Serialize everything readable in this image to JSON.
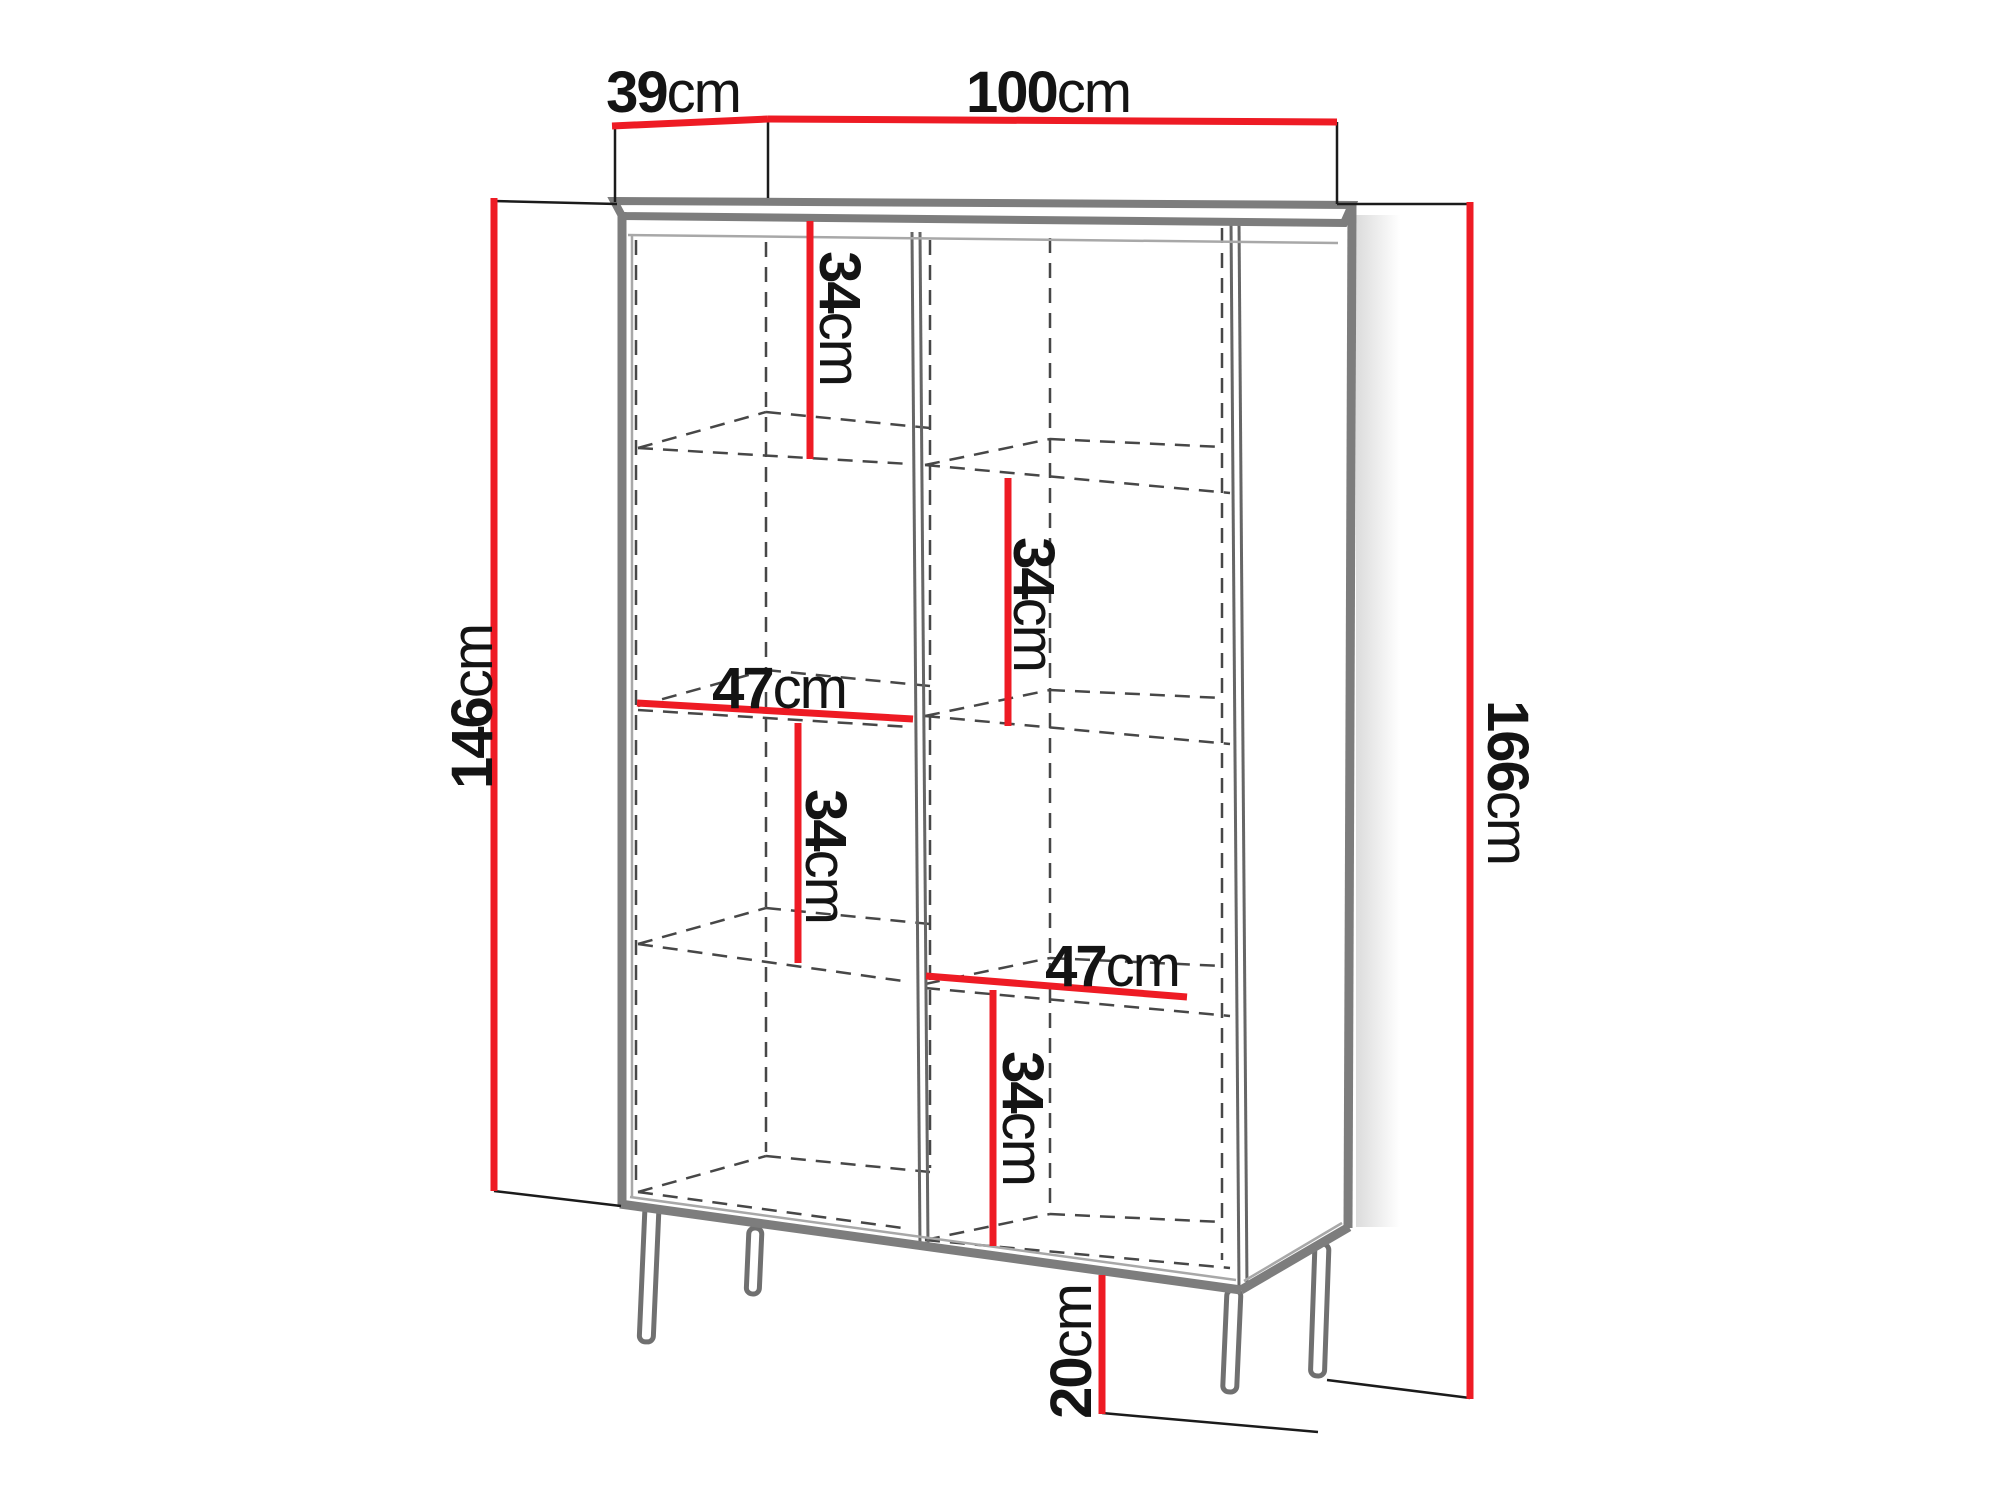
{
  "diagram_title": "Cabinet dimension drawing",
  "colors": {
    "dimension_line": "#ee1b24",
    "outline_gray": "#7d7d7d",
    "hidden_line": "#474747",
    "text": "#141414"
  },
  "dims": {
    "depth": {
      "value": "39",
      "unit": "cm"
    },
    "width": {
      "value": "100",
      "unit": "cm"
    },
    "carcass_height": {
      "value": "146",
      "unit": "cm"
    },
    "total_height": {
      "value": "166",
      "unit": "cm"
    },
    "left_top_gap": {
      "value": "34",
      "unit": "cm"
    },
    "right_upper_gap": {
      "value": "34",
      "unit": "cm"
    },
    "left_inner_width": {
      "value": "47",
      "unit": "cm"
    },
    "left_lower_gap": {
      "value": "34",
      "unit": "cm"
    },
    "right_inner_width": {
      "value": "47",
      "unit": "cm"
    },
    "right_lower_gap": {
      "value": "34",
      "unit": "cm"
    },
    "leg_height": {
      "value": "20",
      "unit": "cm"
    }
  }
}
